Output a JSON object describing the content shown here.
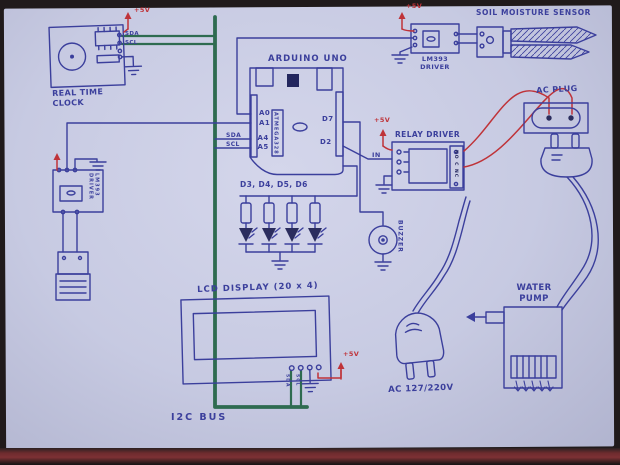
{
  "colors": {
    "paper": "#c7cae2",
    "ink": "#3b3f9c",
    "i2c_bus_green": "#2e6b50",
    "ac_wire_red": "#bf3339",
    "table_edge": "#7d3134"
  },
  "labels": {
    "rtc": "REAL TIME\nCLOCK",
    "rtc_pin_sda": "SDA",
    "rtc_pin_scl": "SCL",
    "arduino": "ARDUINO UNO",
    "arduino_chip": "ATMEGA328",
    "pin_a0": "A0",
    "pin_a1": "A1",
    "pin_a4": "A4",
    "pin_a5": "A5",
    "pin_d7": "D7",
    "pin_d2": "D2",
    "bus_sda": "SDA",
    "bus_scl": "SCL",
    "led_pins": "D3, D4, D5, D6",
    "lcd": "LCD DISPLAY (20 x 4)",
    "lcd_pin_sda": "SDA",
    "lcd_pin_scl": "SCL",
    "i2c_bus": "I2C BUS",
    "lm393_top": "LM393\nDRIVER",
    "lm393_left": "LM393 DRIVER",
    "soil_sensor": "SOIL MOISTURE SENSOR",
    "relay": "RELAY DRIVER",
    "relay_in": "IN",
    "relay_terminals": "NO C NC",
    "buzzer": "BUZZER",
    "ac_plug": "AC PLUG",
    "water_pump": "WATER\nPUMP",
    "ac_supply": "AC 127/220V",
    "power": "+5V"
  }
}
